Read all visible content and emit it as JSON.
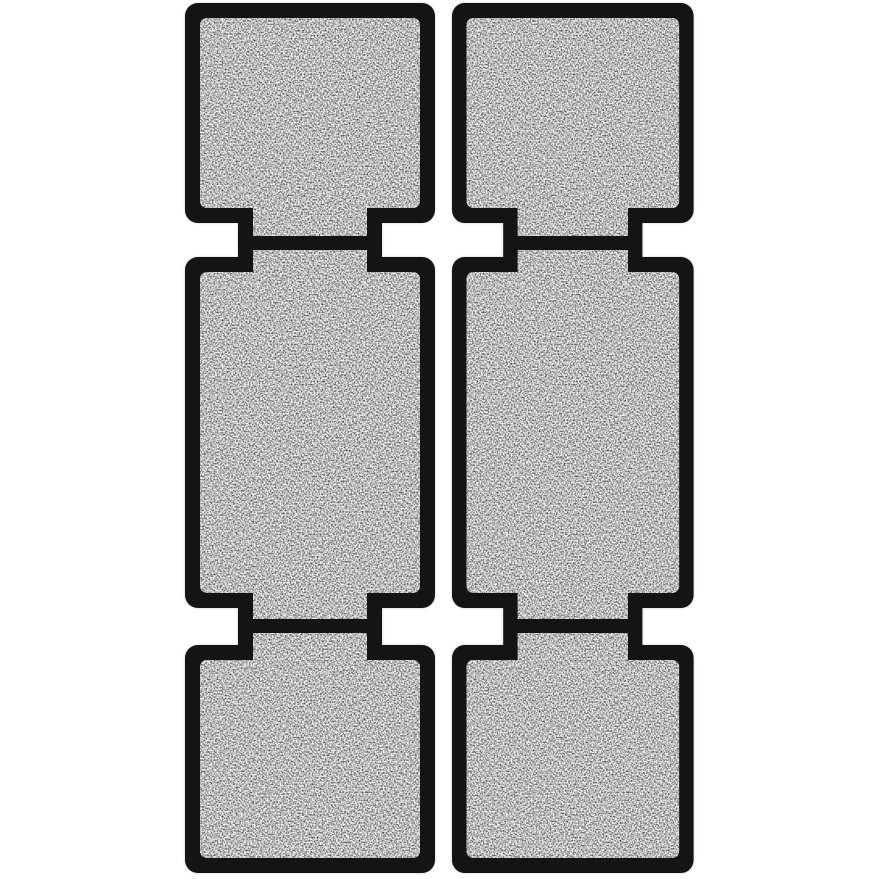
{
  "image": {
    "alt": "Two black-framed gray foam filter strips, each made of three hinged panels (top square, tall middle rectangle, bottom square) connected by narrow necks with black seam bars, photographed on a white background",
    "background": "#ffffff",
    "colors": {
      "frame": "#141414",
      "foam_base": "#b6b6b6",
      "foam_highlight": "#ffffff",
      "foam_shadow": "#6e6e6e"
    },
    "strips": [
      {
        "id": "left",
        "label": "left filter strip",
        "sections": [
          "top square panel",
          "middle tall panel",
          "bottom square panel"
        ],
        "hinge_count": 2
      },
      {
        "id": "right",
        "label": "right filter strip",
        "sections": [
          "top square panel",
          "middle tall panel",
          "bottom square panel"
        ],
        "hinge_count": 2
      }
    ]
  }
}
